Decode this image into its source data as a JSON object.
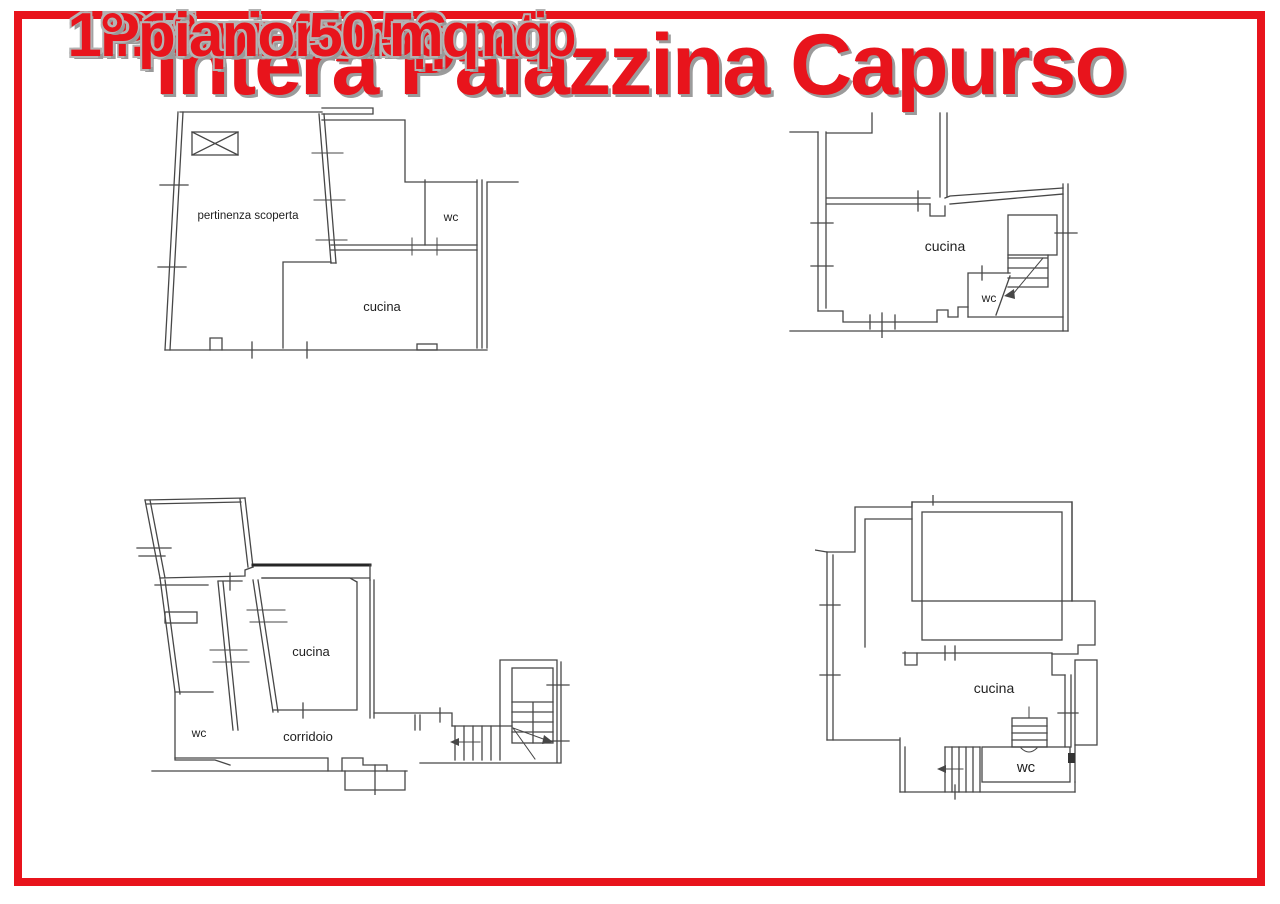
{
  "colors": {
    "accent_red": "#e8141c",
    "shadow_gray": "#9b9b9b",
    "drawing_line": "#474747",
    "background": "#ffffff"
  },
  "title": {
    "text": "Intera Palazzina Capurso"
  },
  "plans": [
    {
      "name": "ground-floor-left",
      "caption": "P. Terra 63 mq - patio",
      "area_mq": 63,
      "rooms": [
        "pertinenza scoperta",
        "wc",
        "cucina"
      ]
    },
    {
      "name": "ground-floor-right",
      "caption": "P.terra 41 mq",
      "area_mq": 41,
      "rooms": [
        "cucina",
        "wc"
      ]
    },
    {
      "name": "first-floor-left",
      "caption": "1° piano 56 mq",
      "area_mq": 56,
      "rooms": [
        "cucina",
        "wc",
        "corridoio"
      ]
    },
    {
      "name": "first-floor-right",
      "caption": "1° piano 50 mq",
      "area_mq": 50,
      "rooms": [
        "cucina",
        "wc"
      ]
    }
  ]
}
